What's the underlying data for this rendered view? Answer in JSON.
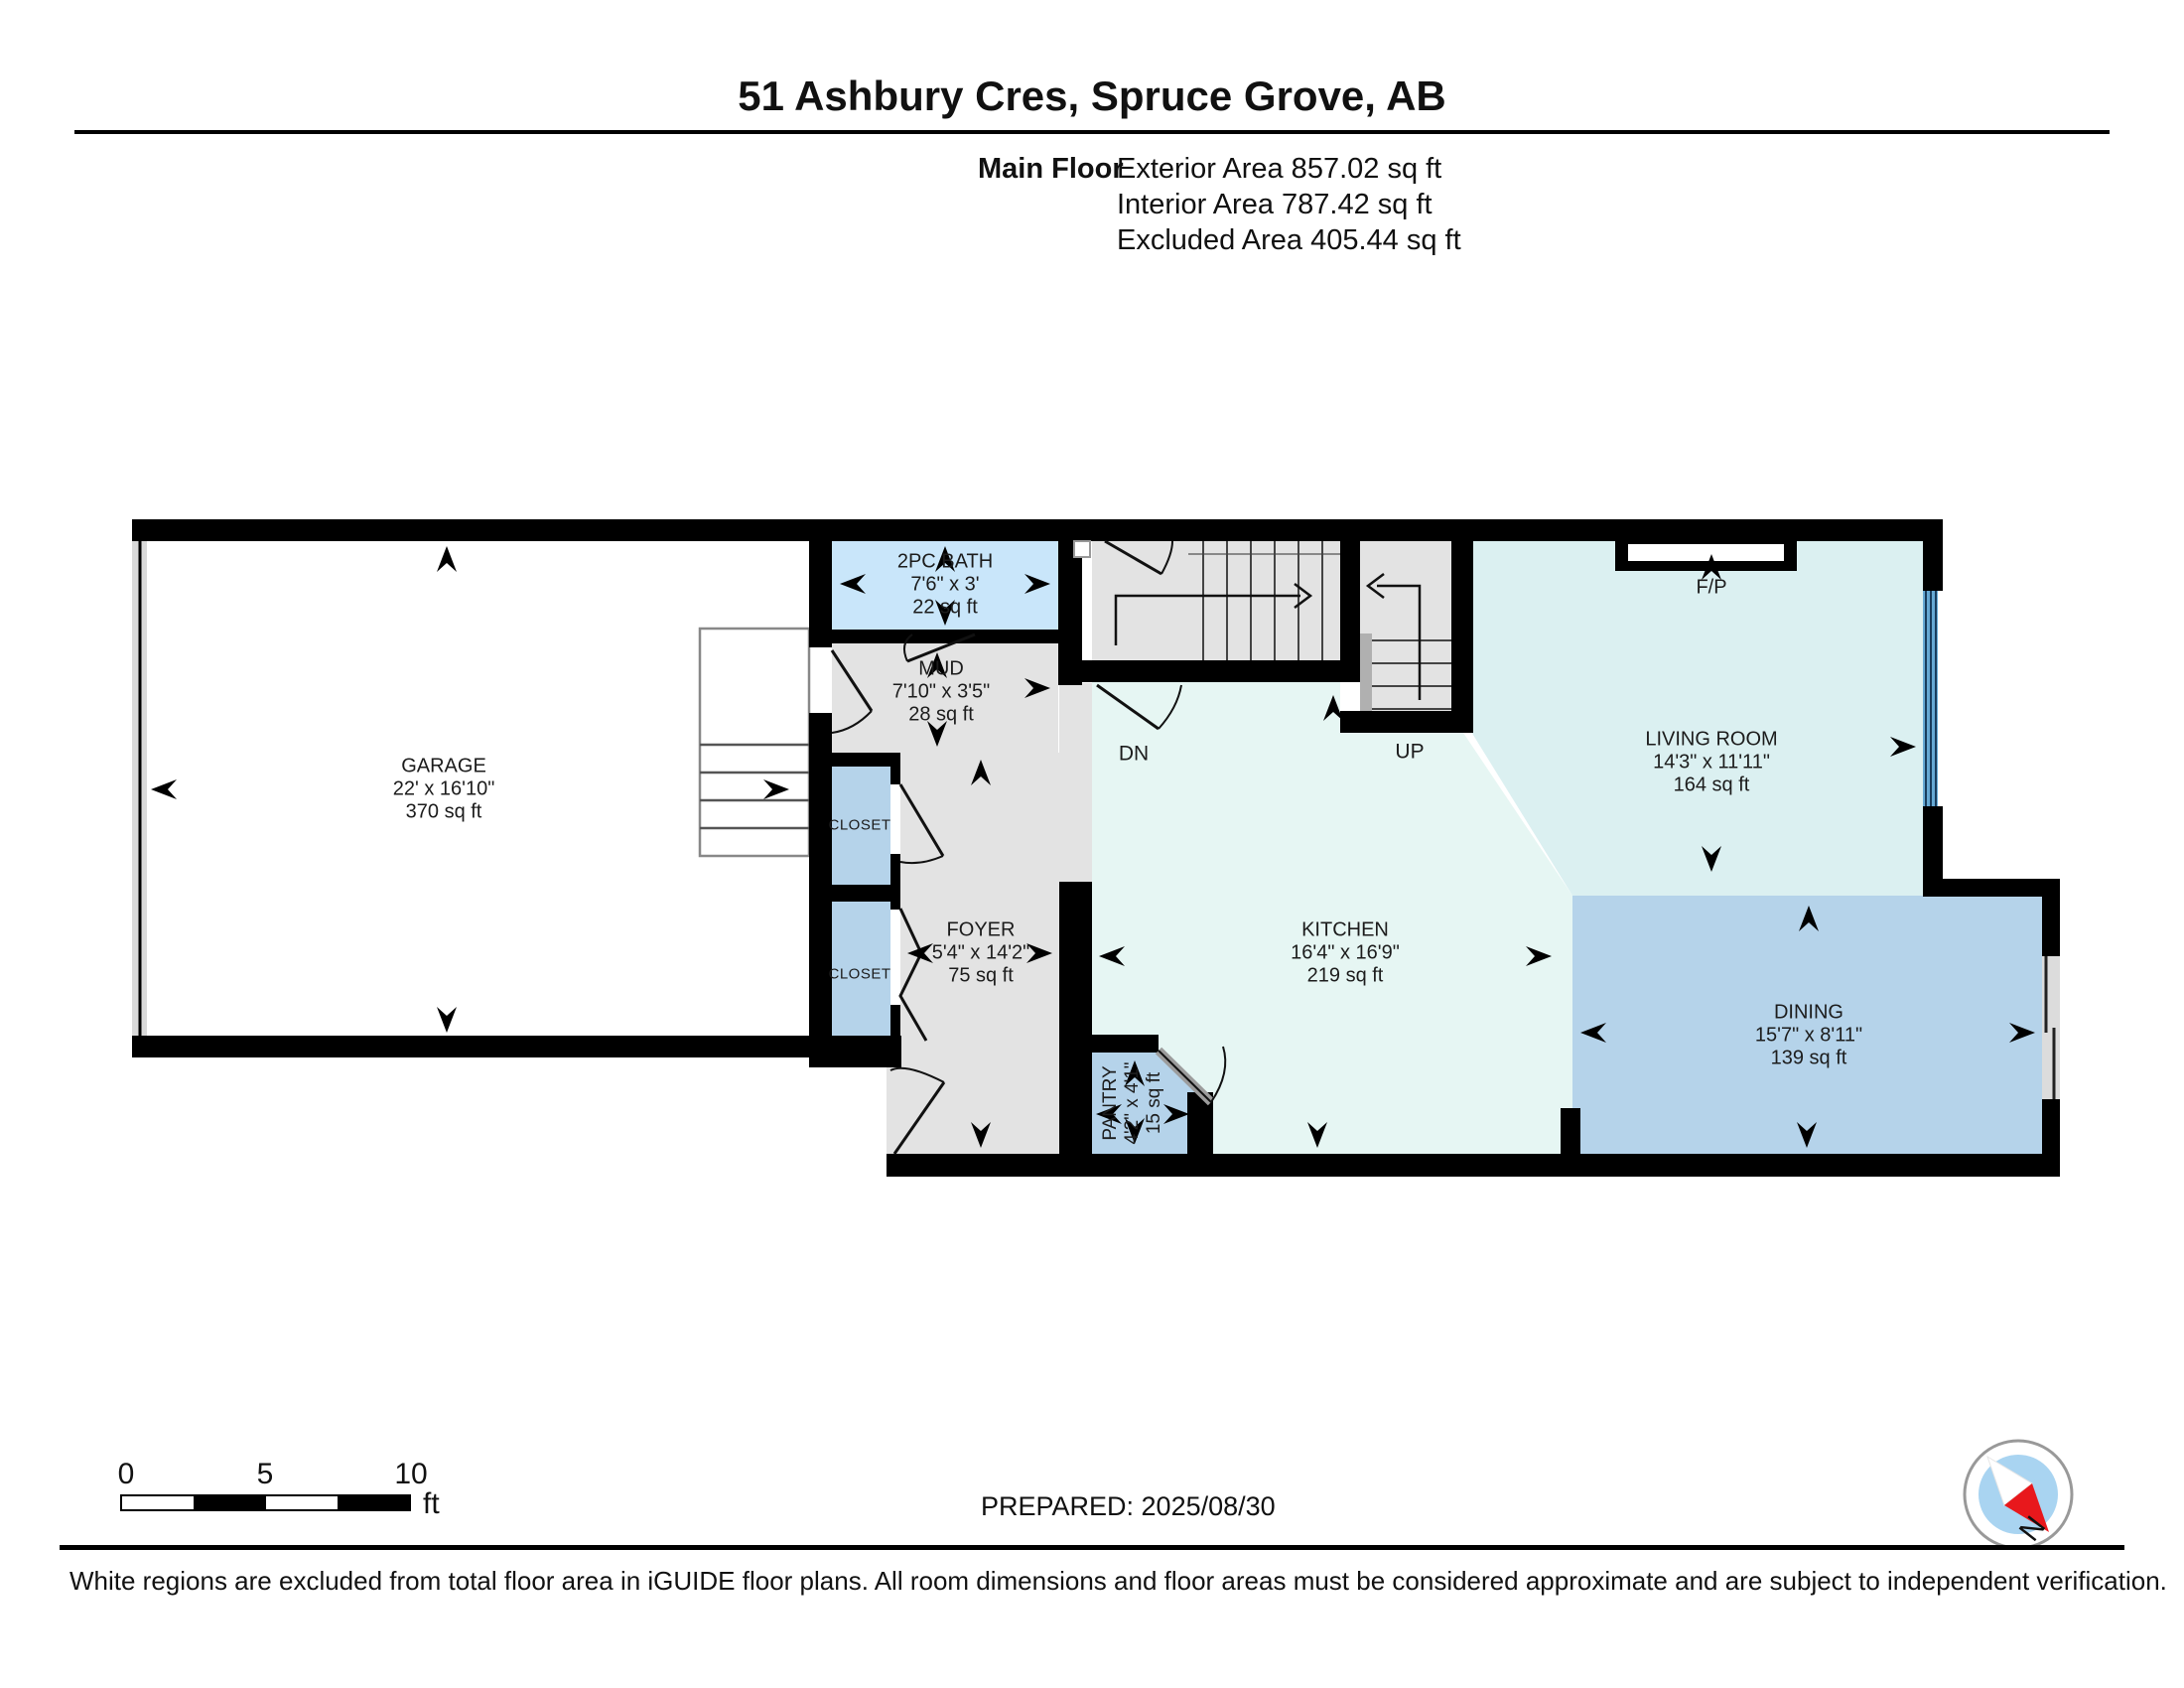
{
  "header": {
    "title": "51 Ashbury Cres, Spruce Grove, AB",
    "floor_label": "Main Floor",
    "exterior_area": "Exterior Area 857.02 sq ft",
    "interior_area": "Interior Area 787.42 sq ft",
    "excluded_area": "Excluded Area 405.44 sq ft"
  },
  "rooms": {
    "garage": {
      "name": "GARAGE",
      "dims": "22' x 16'10\"",
      "area": "370 sq ft"
    },
    "bath": {
      "name": "2PC BATH",
      "dims": "7'6\" x 3'",
      "area": "22 sq ft"
    },
    "mud": {
      "name": "MUD",
      "dims": "7'10\" x 3'5\"",
      "area": "28 sq ft"
    },
    "foyer": {
      "name": "FOYER",
      "dims": "5'4\" x 14'2\"",
      "area": "75 sq ft"
    },
    "kitchen": {
      "name": "KITCHEN",
      "dims": "16'4\" x 16'9\"",
      "area": "219 sq ft"
    },
    "living": {
      "name": "LIVING ROOM",
      "dims": "14'3\" x 11'11\"",
      "area": "164 sq ft"
    },
    "dining": {
      "name": "DINING",
      "dims": "15'7\" x 8'11\"",
      "area": "139 sq ft"
    },
    "pantry": {
      "name": "PANTRY",
      "dims": "4'2\" x 4'1\"",
      "area": "15 sq ft"
    },
    "closet_label": "CLOSET"
  },
  "annotations": {
    "fireplace": "F/P",
    "stairs_up": "UP",
    "stairs_down": "DN",
    "compass_north": "N"
  },
  "scale_bar": {
    "ticks": [
      "0",
      "5",
      "10"
    ],
    "unit": "ft"
  },
  "footer": {
    "prepared": "PREPARED: 2025/08/30",
    "disclaimer": "White regions are excluded from total floor area in iGUIDE floor plans. All room dimensions and floor areas must be considered approximate and are subject to independent verification."
  },
  "colors": {
    "wall": "#000000",
    "room_gray": "#e3e3e3",
    "room_blue_light": "#c9e6fa",
    "room_blue": "#b5d3ea",
    "kitchen_fill": "#e6f6f3",
    "living_fill": "#dbf0f1",
    "window_blue": "#66a9d4",
    "compass_inner": "#a9d4f1",
    "compass_red": "#e8181c"
  }
}
